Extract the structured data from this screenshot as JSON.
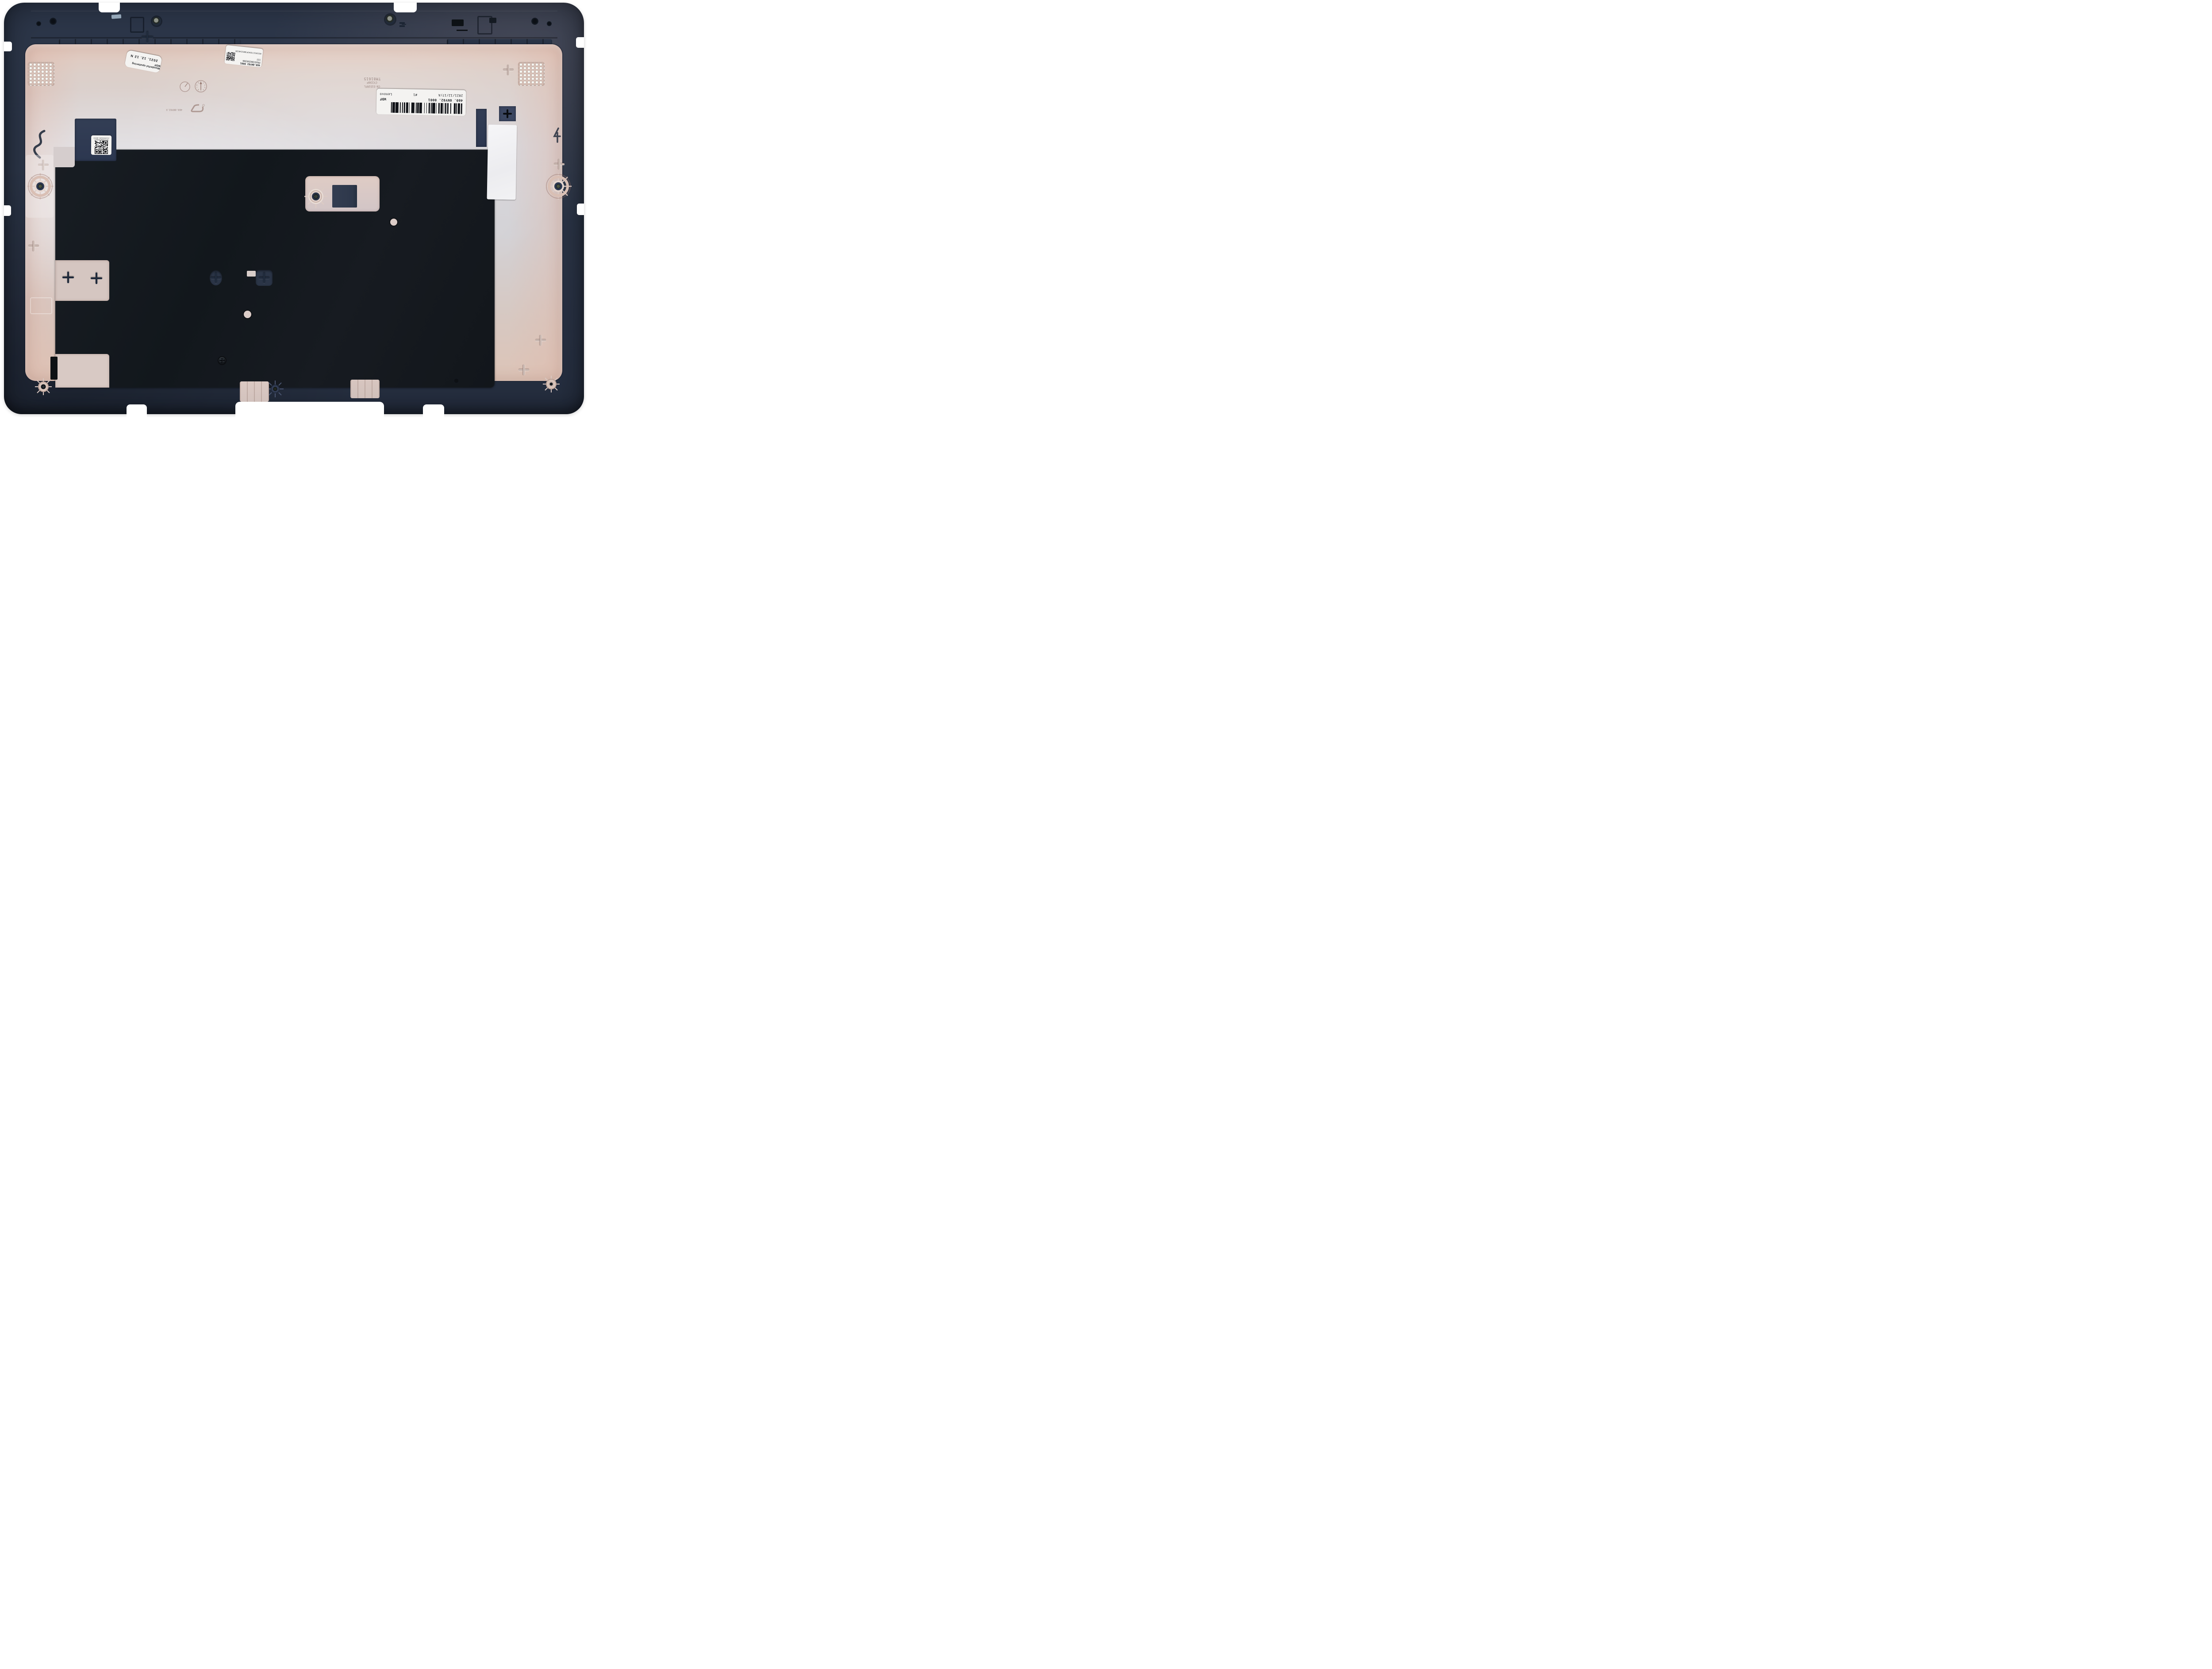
{
  "scene": {
    "type": "product-photo",
    "subject": "Lenovo laptop LCD back cover, inner side, on white background",
    "background": "#ffffff"
  },
  "palette": {
    "navy_plastic": "#2b3547",
    "navy_deep": "#1d2636",
    "graphite_sheet": "#14191f",
    "shield_pink": "#ddc5ba",
    "shield_silver": "#d4d2d6",
    "label_white": "#f4f3f1",
    "metal_insert": "#3c4438"
  },
  "stickers": {
    "sputter": {
      "line1": "Wonderful sputtering WDF",
      "line2": "2021. 12. 12    N",
      "orientation": "printed upside-down in photo"
    },
    "fru": {
      "part": "460.0NY02 0001",
      "fru": "FRU5CB0Z69366",
      "station": "112",
      "serial": "8SSCB1C72042P3WD1CH032R",
      "orientation": "printed upside-down in photo"
    },
    "main": {
      "part": "460. 0NY02. 0001",
      "plant": "WDF",
      "date": "2021/12/17/A",
      "count": "#1",
      "brand": "Lenovo",
      "orientation": "printed upside-down in photo",
      "barcode_pattern": "21311124122121113122114111221213312112421131211212413111"
    },
    "qr": {
      "line1": "MFC4340NY020021",
      "line2": "21120101A01-0633Z",
      "orientation": "printed upside-down in photo"
    },
    "blank": {
      "note": ""
    }
  },
  "molded": {
    "mold_id_lines": [
      "TM81615",
      "CY230P",
      "CN-5151RFL"
    ],
    "part_emboss": "460.0NY02.X",
    "dial_digits": "0123456789"
  }
}
